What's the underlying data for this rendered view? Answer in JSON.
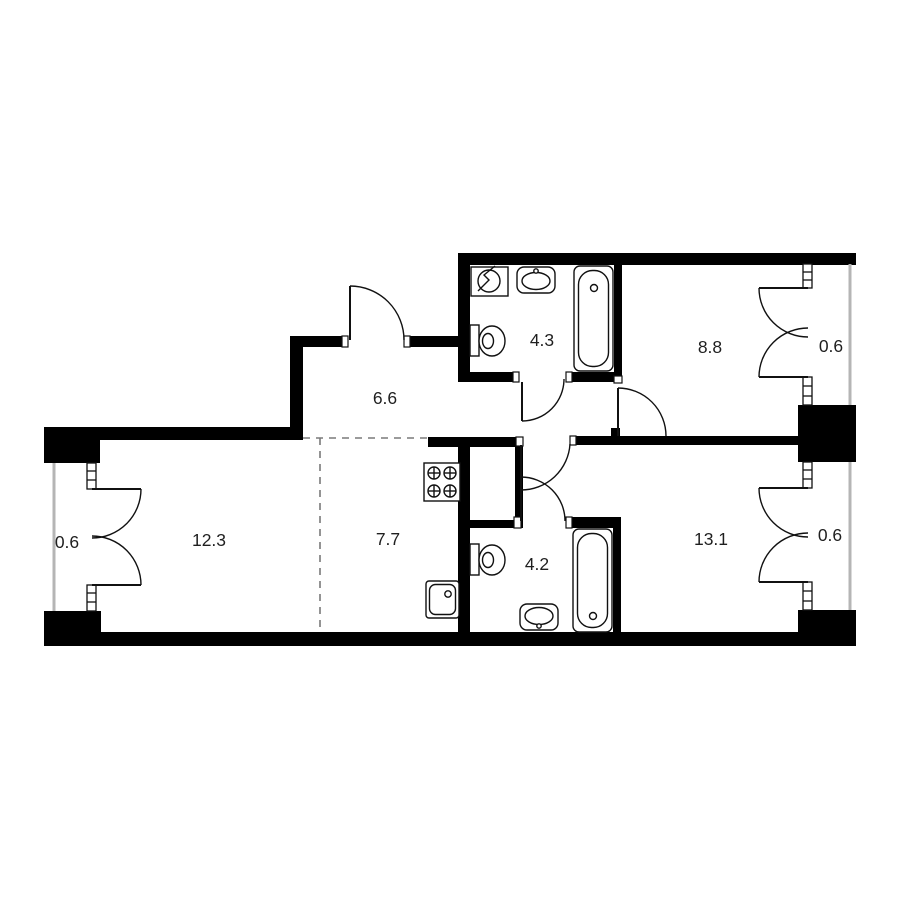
{
  "plan": {
    "type": "apartment-floor-plan",
    "rooms": [
      {
        "name": "hallway",
        "area_label": "6.6"
      },
      {
        "name": "bathroom-upper",
        "area_label": "4.3"
      },
      {
        "name": "room-upper",
        "area_label": "8.8"
      },
      {
        "name": "balcony-upper-right",
        "area_label": "0.6"
      },
      {
        "name": "balcony-left",
        "area_label": "0.6"
      },
      {
        "name": "living-room",
        "area_label": "12.3"
      },
      {
        "name": "kitchen",
        "area_label": "7.7"
      },
      {
        "name": "bathroom-lower",
        "area_label": "4.2"
      },
      {
        "name": "room-lower",
        "area_label": "13.1"
      },
      {
        "name": "balcony-lower-right",
        "area_label": "0.6"
      }
    ],
    "fixtures": [
      {
        "name": "ventilation-fan",
        "room": "bathroom-upper"
      },
      {
        "name": "washbasin",
        "room": "bathroom-upper"
      },
      {
        "name": "bathtub",
        "room": "bathroom-upper"
      },
      {
        "name": "toilet",
        "room": "bathroom-upper"
      },
      {
        "name": "stove",
        "room": "kitchen"
      },
      {
        "name": "kitchen-sink",
        "room": "kitchen"
      },
      {
        "name": "toilet",
        "room": "bathroom-lower"
      },
      {
        "name": "washbasin",
        "room": "bathroom-lower"
      },
      {
        "name": "bathtub",
        "room": "bathroom-lower"
      }
    ],
    "colors": {
      "wall": "#000000",
      "fixture_line": "#111111",
      "balcony_wall": "#b5b5b5",
      "dashed_line": "#7a7a7a",
      "label": "#1f1f1f",
      "background": "#ffffff"
    }
  }
}
